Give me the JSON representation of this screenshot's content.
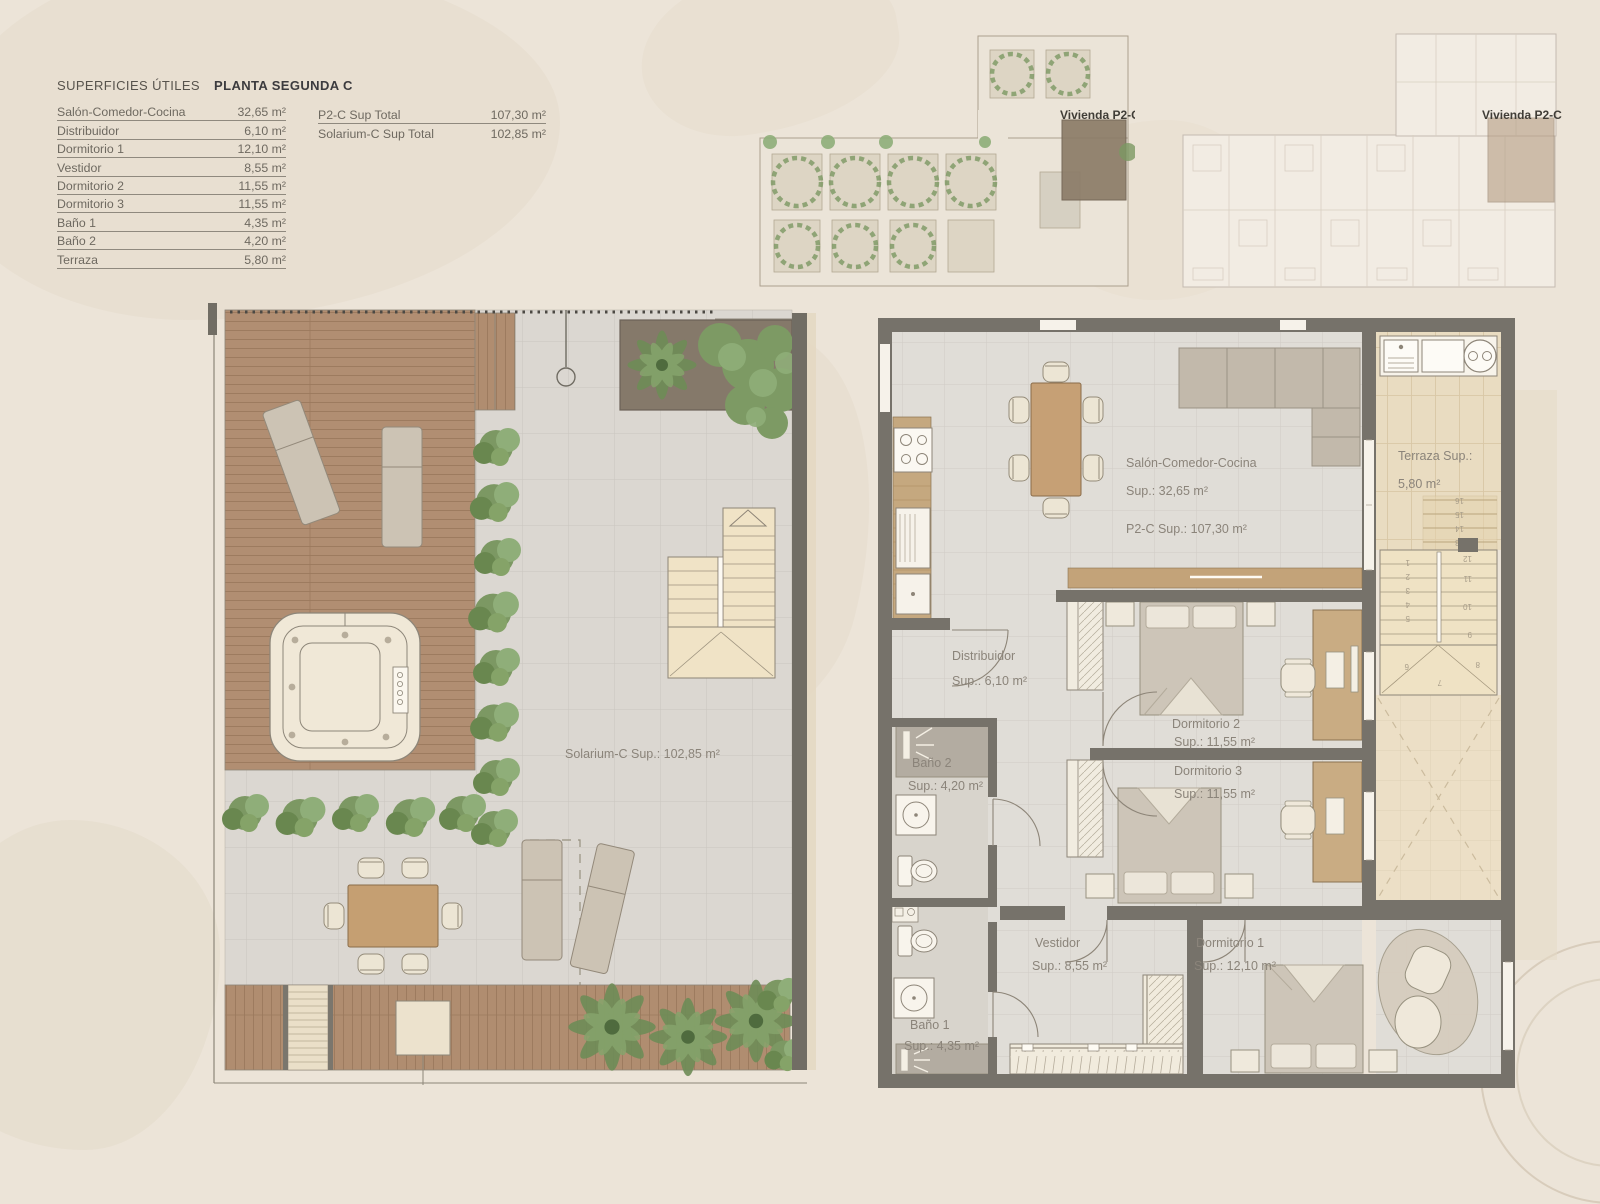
{
  "page": {
    "background": "#ece4d8"
  },
  "legend": {
    "title_main": "SUPERFICIES ÚTILES",
    "title_plan": "PLANTA SEGUNDA C",
    "rows": [
      {
        "label": "Salón-Comedor-Cocina",
        "value": "32,65 m²"
      },
      {
        "label": "Distribuidor",
        "value": "6,10 m²"
      },
      {
        "label": "Dormitorio 1",
        "value": "12,10 m²"
      },
      {
        "label": "Vestidor",
        "value": "8,55 m²"
      },
      {
        "label": "Dormitorio 2",
        "value": "11,55 m²"
      },
      {
        "label": "Dormitorio 3",
        "value": "11,55 m²"
      },
      {
        "label": "Baño 1",
        "value": "4,35 m²"
      },
      {
        "label": "Baño 2",
        "value": "4,20 m²"
      },
      {
        "label": "Terraza",
        "value": "5,80 m²"
      }
    ],
    "totals": [
      {
        "label": "P2-C Sup Total",
        "value": "107,30 m²"
      },
      {
        "label": "Solarium-C Sup Total",
        "value": "102,85 m²"
      }
    ]
  },
  "overview_plans": [
    {
      "unit_label": "Vivienda P2-C"
    },
    {
      "unit_label": "Vivienda P2-C"
    }
  ],
  "solarium": {
    "area_label": "Solarium-C Sup.: 102,85 m²"
  },
  "apartment": {
    "rooms": [
      {
        "name": "Salón-Comedor-Cocina",
        "sup": "Sup.: 32,65 m²"
      },
      {
        "name": "Terraza Sup.:",
        "sup": "5,80 m²"
      },
      {
        "name": "Distribuidor",
        "sup": "Sup.: 6,10 m²"
      },
      {
        "name": "Dormitorio 2",
        "sup": "Sup.: 11,55 m²"
      },
      {
        "name": "Dormitorio 3",
        "sup": "Sup.: 11,55 m²"
      },
      {
        "name": "Baño 2",
        "sup": "Sup.: 4,20 m²"
      },
      {
        "name": "Baño 1",
        "sup": "Sup.: 4,35 m²"
      },
      {
        "name": "Vestidor",
        "sup": "Sup.: 8,55 m²"
      },
      {
        "name": "Dormitorio 1",
        "sup": "Sup.: 12,10 m²"
      }
    ],
    "total_label": "P2-C Sup.: 107,30 m²",
    "stair_steps": [
      "1",
      "2",
      "3",
      "4",
      "5",
      "6",
      "7",
      "8",
      "9",
      "10",
      "11",
      "12",
      "13",
      "14",
      "15",
      "16"
    ]
  },
  "colors": {
    "wall": "#76726a",
    "wood_deck": "#b18e72",
    "tile": "#dcd8d2",
    "hedge_green": "#7c9863",
    "terrace_beige": "#e8dabf",
    "label_text": "#8b847a",
    "highlight_unit": "#8c7c68"
  }
}
